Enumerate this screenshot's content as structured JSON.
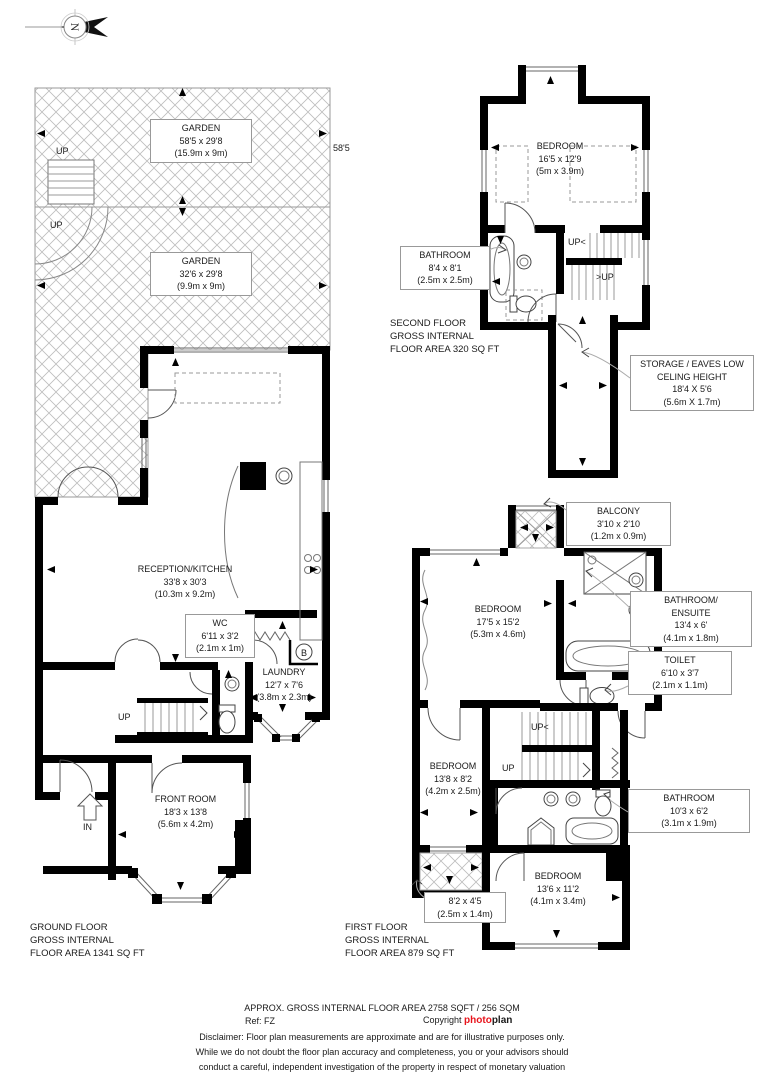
{
  "compass": {
    "letter": "N"
  },
  "colors": {
    "wall": "#000000",
    "hatch_line": "#b9b9b9",
    "logo_red": "#e8131b",
    "text": "#1a1a1a"
  },
  "ground_floor": {
    "garden_top": {
      "name": "GARDEN",
      "dims": "58'5 x 29'8",
      "metric": "(15.9m x 9m)"
    },
    "garden_depth": "58'5",
    "garden_bottom": {
      "name": "GARDEN",
      "dims": "32'6 x 29'8",
      "metric": "(9.9m x 9m)"
    },
    "up_garden_stairs": "UP",
    "up_garden_path": "UP",
    "reception": {
      "name": "RECEPTION/KITCHEN",
      "dims": "33'8 x 30'3",
      "metric": "(10.3m x 9.2m)"
    },
    "wc": {
      "name": "WC",
      "dims": "6'11 x 3'2",
      "metric": "(2.1m x 1m)"
    },
    "laundry": {
      "name": "LAUNDRY",
      "dims": "12'7 x 7'6",
      "metric": "(3.8m x 2.3m)"
    },
    "boiler": "B",
    "up_stairs": "UP",
    "entrance": "IN",
    "front_room": {
      "name": "FRONT ROOM",
      "dims": "18'3 x 13'8",
      "metric": "(5.6m x 4.2m)"
    },
    "caption": {
      "line1": "GROUND FLOOR",
      "line2": "GROSS INTERNAL",
      "line3": "FLOOR AREA 1341 SQ FT"
    }
  },
  "second_floor": {
    "bedroom": {
      "name": "BEDROOM",
      "dims": "16'5 x 12'9",
      "metric": "(5m x 3.9m)"
    },
    "bathroom": {
      "name": "BATHROOM",
      "dims": "8'4 x 8'1",
      "metric": "(2.5m x 2.5m)"
    },
    "up_upper": "UP<",
    "up_lower": ">UP",
    "storage": {
      "line1": "STORAGE / EAVES LOW",
      "line2": "CELING HEIGHT",
      "dims": "18'4 X 5'6",
      "metric": "(5.6m X 1.7m)"
    },
    "caption": {
      "line1": "SECOND FLOOR",
      "line2": "GROSS INTERNAL",
      "line3": "FLOOR AREA 320 SQ FT"
    }
  },
  "first_floor": {
    "balcony": {
      "name": "BALCONY",
      "dims": "3'10 x 2'10",
      "metric": "(1.2m x 0.9m)"
    },
    "bedroom_front": {
      "name": "BEDROOM",
      "dims": "17'5 x 15'2",
      "metric": "(5.3m x 4.6m)"
    },
    "bathroom_ensuite": {
      "name_line1": "BATHROOM/",
      "name_line2": "ENSUITE",
      "dims": "13'4 x 6'",
      "metric": "(4.1m x 1.8m)"
    },
    "toilet": {
      "name": "TOILET",
      "dims": "6'10 x 3'7",
      "metric": "(2.1m x 1.1m)"
    },
    "bedroom_middle": {
      "name": "BEDROOM",
      "dims": "13'8 x 8'2",
      "metric": "(4.2m x 2.5m)"
    },
    "up_upper": "UP<",
    "up_lower": "UP",
    "bathroom": {
      "name": "BATHROOM",
      "dims": "10'3 x 6'2",
      "metric": "(3.1m x 1.9m)"
    },
    "roof_terrace": {
      "dims": "8'2 x 4'5",
      "metric": "(2.5m x 1.4m)"
    },
    "bedroom_back": {
      "name": "BEDROOM",
      "dims": "13'6 x 11'2",
      "metric": "(4.1m x 3.4m)"
    },
    "caption": {
      "line1": "FIRST FLOOR",
      "line2": "GROSS INTERNAL",
      "line3": "FLOOR AREA 879 SQ FT"
    }
  },
  "footer": {
    "area_summary": "APPROX. GROSS INTERNAL FLOOR AREA 2758 SQFT / 256 SQM",
    "ref": "Ref: FZ",
    "copyright_label": "Copyright",
    "logo_part1": "photo",
    "logo_part2": "plan",
    "disclaimer_line1": "Disclaimer: Floor plan measurements are approximate and are for illustrative purposes only.",
    "disclaimer_line2": "While we do not doubt the floor plan accuracy and completeness, you or your advisors should",
    "disclaimer_line3": "conduct a careful, independent investigation of the property in respect of monetary valuation"
  }
}
